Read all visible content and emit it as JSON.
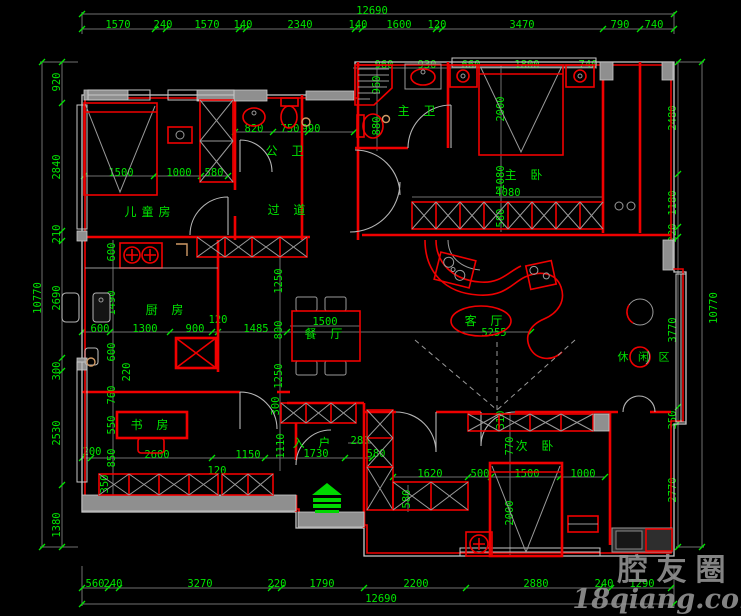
{
  "dims": {
    "top": {
      "total": "12690",
      "chain": [
        "1570",
        "240",
        "1570",
        "140",
        "2340",
        "140",
        "1600",
        "120",
        "3470",
        "790",
        "740"
      ]
    },
    "bottom": {
      "total": "12690",
      "chain": [
        "560",
        "240",
        "3270",
        "220",
        "1790",
        "2200",
        "2880",
        "240",
        "1290"
      ]
    },
    "left": {
      "total": "10770",
      "chain": [
        "920",
        "2840",
        "210",
        "2690",
        "300",
        "2530",
        "1380"
      ]
    },
    "right": {
      "total": "10770",
      "chain": [
        "2480",
        "1180",
        "220",
        "3770",
        "350",
        "2770"
      ]
    },
    "inner": {
      "bath_row": [
        "820",
        "750",
        "990"
      ],
      "child_row": [
        "1500",
        "1000",
        "580"
      ],
      "master_row": [
        "960",
        "930",
        "660",
        "1800",
        "740"
      ],
      "master_v": [
        "960",
        "880",
        "2000",
        "1080",
        "580"
      ],
      "master_w": "4080",
      "kitchen_row": [
        "600",
        "1300",
        "900",
        "1485"
      ],
      "kitchen_gap": "120",
      "left_v": [
        "600",
        "1490",
        "600",
        "220",
        "760",
        "550",
        "850",
        "350"
      ],
      "dining_v": [
        "1250",
        "800",
        "1250",
        "300",
        "1110"
      ],
      "dining_w": "1500",
      "living_w": "5255",
      "study_row": [
        "200",
        "2600",
        "1150",
        "1730",
        "580"
      ],
      "study_gap": "120",
      "entry_w": "280",
      "bed2_row": [
        "1620",
        "500",
        "1500",
        "1000"
      ],
      "bed2_v": [
        "310",
        "770",
        "580",
        "2000"
      ]
    }
  },
  "rooms": {
    "children": "儿童房",
    "public_bath": "公 卫",
    "corridor": "过 道",
    "master_bath": "主 卫",
    "master_bed": "主 卧",
    "kitchen": "厨 房",
    "dining": "餐 厅",
    "living": "客 厅",
    "leisure": "休 闲 区",
    "study": "书 房",
    "entry": "入 户",
    "second_bed": "次 卧"
  },
  "watermark": {
    "brand": "腔友圈",
    "site": "18qiang.com"
  },
  "colors": {
    "background": "#000000",
    "wall": "#f00000",
    "dimension": "#00e400",
    "outline": "#c9c9c9",
    "watermark": "#969696"
  }
}
